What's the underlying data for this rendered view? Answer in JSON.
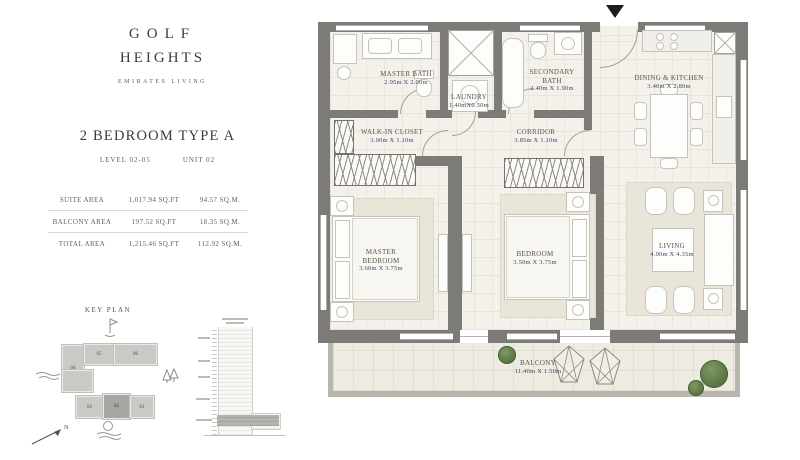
{
  "brand": {
    "name_line1": "GOLF",
    "name_line2": "HEIGHTS",
    "tagline": "EMIRATES LIVING"
  },
  "unit": {
    "title": "2 BEDROOM TYPE A",
    "level": "LEVEL 02-05",
    "unit_no": "UNIT 02"
  },
  "area_table": {
    "rows": [
      {
        "label": "SUITE AREA",
        "sqft": "1,017.94 SQ.FT",
        "sqm": "94.57 SQ.M."
      },
      {
        "label": "BALCONY AREA",
        "sqft": "197.52 SQ.FT",
        "sqm": "18.35 SQ.M."
      },
      {
        "label": "TOTAL AREA",
        "sqft": "1,215.46 SQ.FT",
        "sqm": "112.92 SQ.M."
      }
    ]
  },
  "key_plan": {
    "title": "KEY PLAN",
    "north_label": "N",
    "highlighted_unit": "02",
    "buildings": [
      {
        "id": "04"
      },
      {
        "id": "05"
      },
      {
        "id": "06"
      },
      {
        "id": "03"
      },
      {
        "id": "02"
      },
      {
        "id": "01"
      }
    ]
  },
  "plan": {
    "rooms": [
      {
        "name": "MASTER BATH",
        "dims": "2.95m X 2.00m"
      },
      {
        "name": "LAUNDRY",
        "dims": "1.40mX0.50m"
      },
      {
        "name": "SECONDARY BATH",
        "dims": "2.40m X 1.90m"
      },
      {
        "name": "DINING & KITCHEN",
        "dims": "3.40m X 2.80m"
      },
      {
        "name": "WALK-IN CLOSET",
        "dims": "3.00m X 1.10m"
      },
      {
        "name": "CORRIDOR",
        "dims": "3.85m X 1.10m"
      },
      {
        "name": "MASTER BEDROOM",
        "dims": "3.60m X 3.75m"
      },
      {
        "name": "BEDROOM",
        "dims": "3.50m X 3.75m"
      },
      {
        "name": "LIVING",
        "dims": "4.00m X 4.35m"
      },
      {
        "name": "BALCONY",
        "dims": "11.40m X 1.50m"
      }
    ]
  },
  "colors": {
    "wall": "#7c7b78",
    "floor": "#f3f1ea",
    "dim_text": "#3d4963",
    "label_text": "#57554a",
    "plant": "#5f7d4f"
  }
}
